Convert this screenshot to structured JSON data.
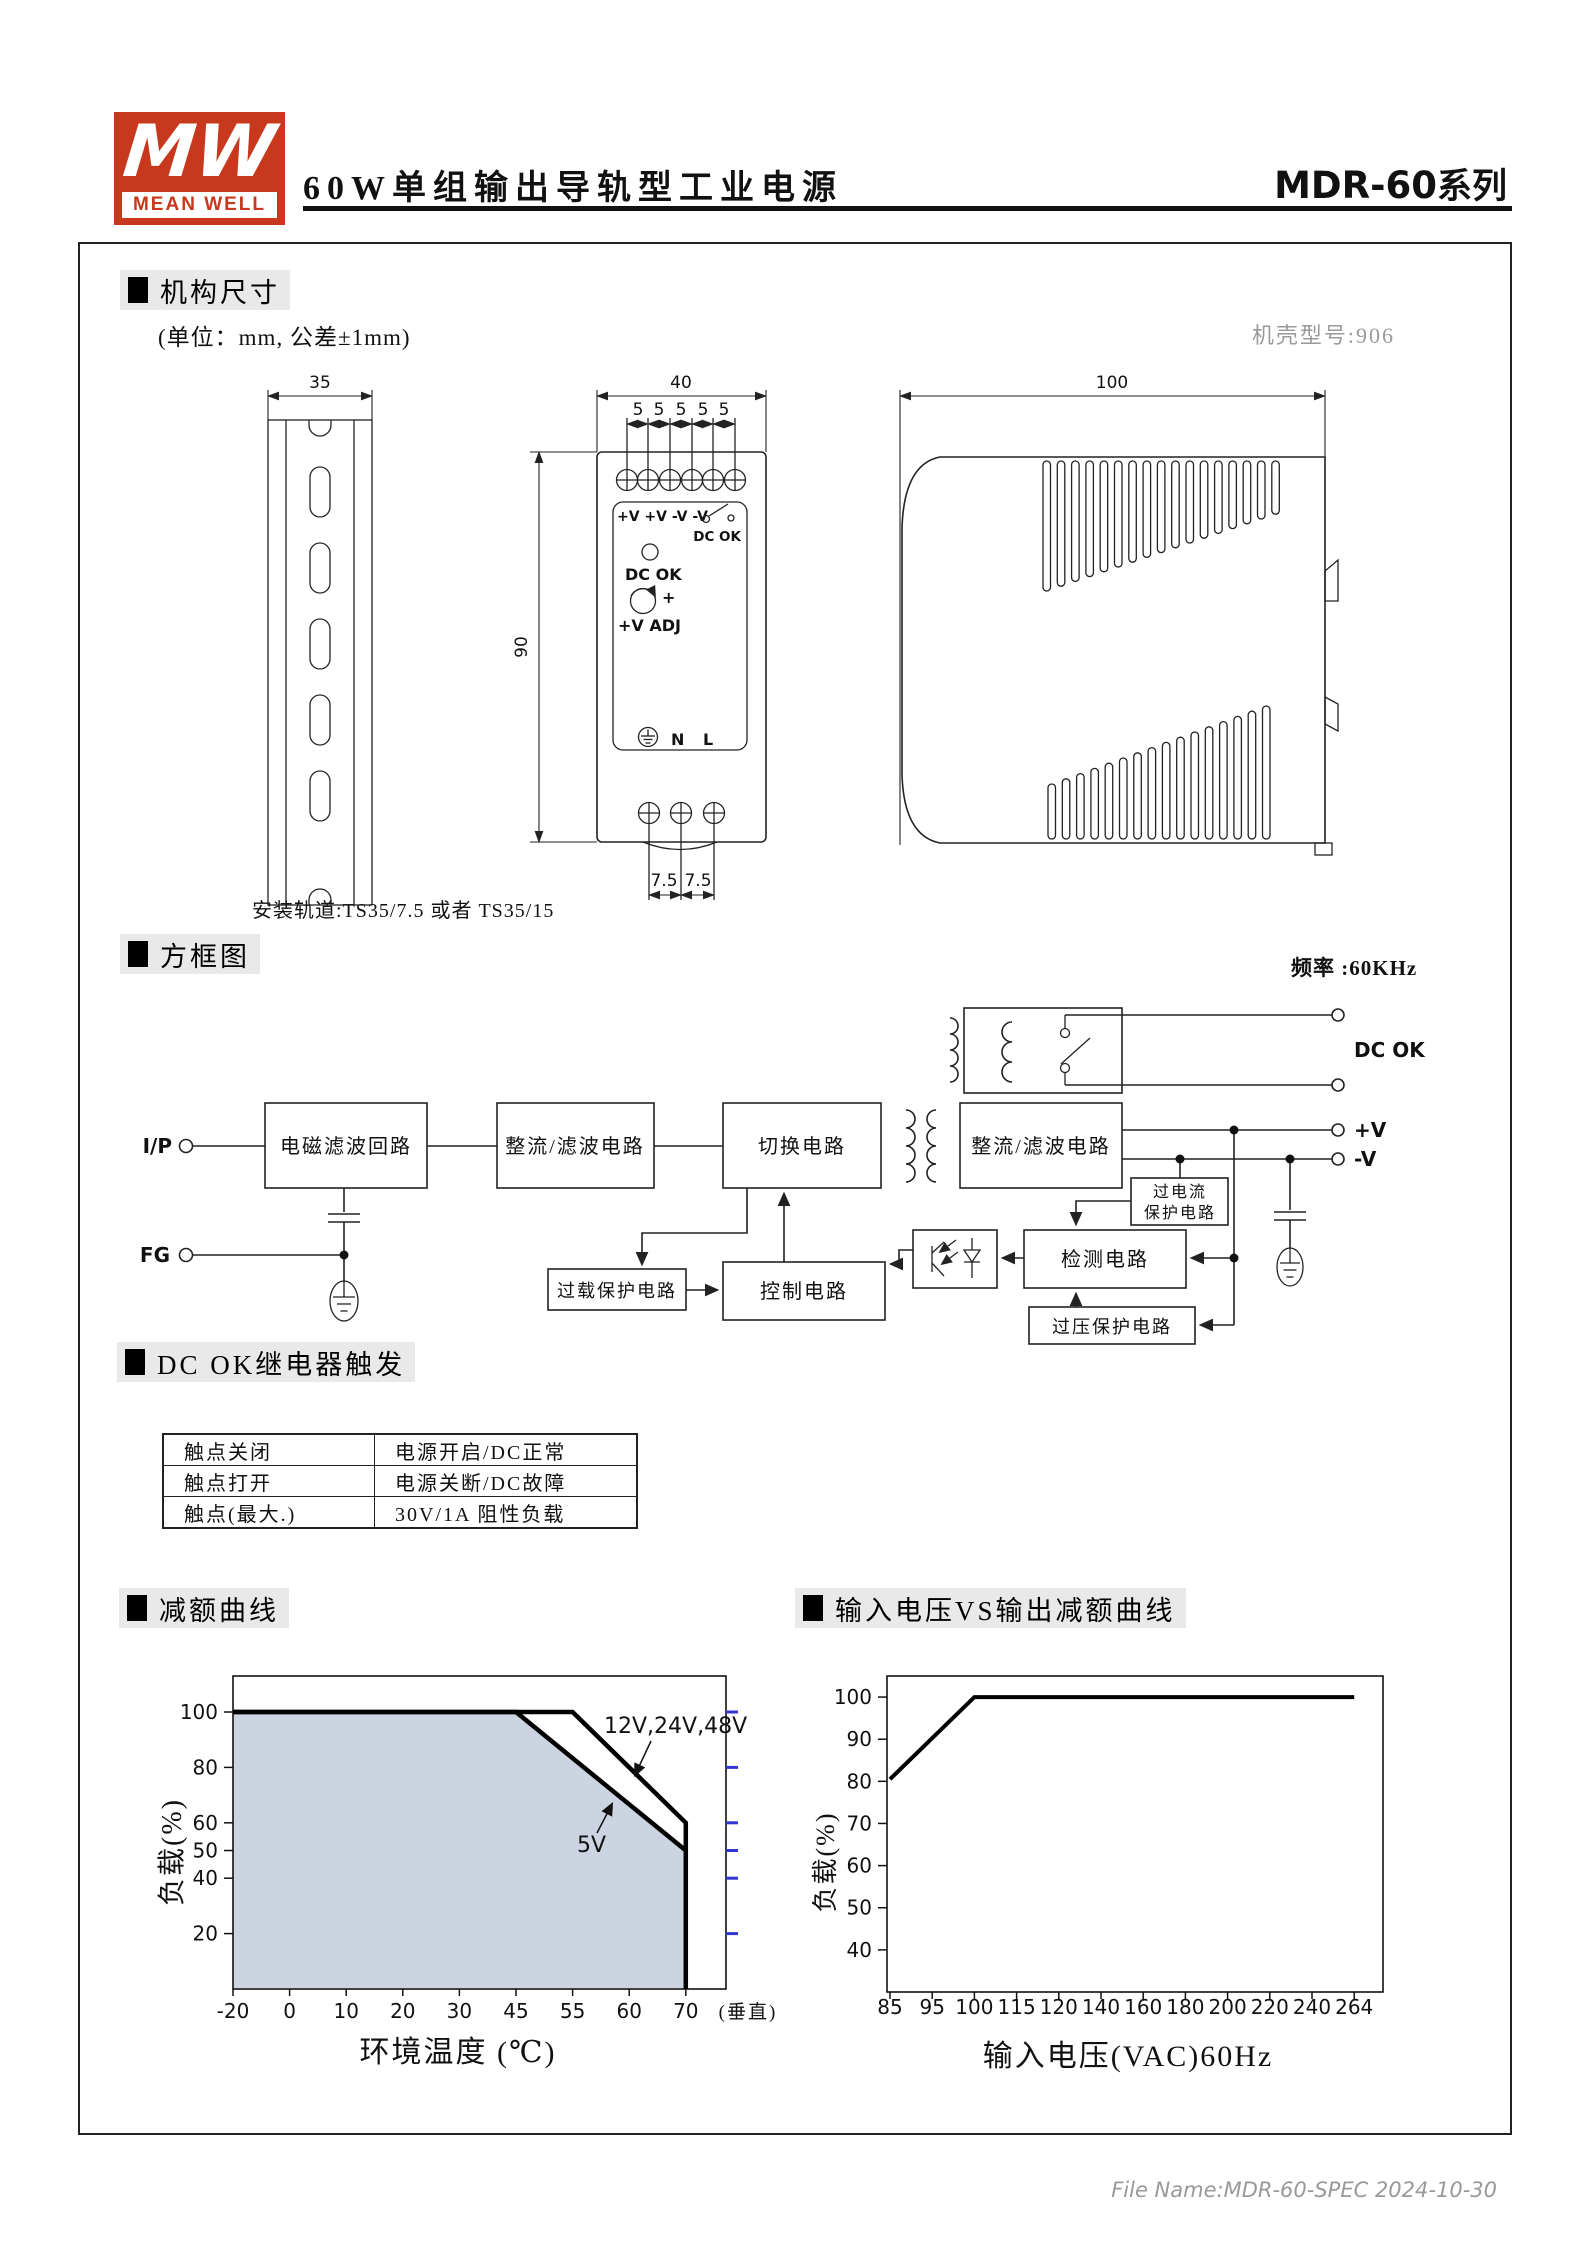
{
  "colors": {
    "brand_red": "#c8381c",
    "heading_bg": "#e9e9e9",
    "shade_fill": "#ccd4e2",
    "accent_blue": "#3434cf",
    "gray_text": "#9a9a9a"
  },
  "header": {
    "logo_mark": "MW",
    "logo_name": "MEAN WELL",
    "title": "60W单组输出导轨型工业电源",
    "series": "MDR-60",
    "series_suffix": "系列"
  },
  "mechanical": {
    "heading": "机构尺寸",
    "unit_note": "(单位：mm, 公差±1mm)",
    "case_note": "机壳型号:906",
    "rail_note": "安装轨道:TS35/7.5 或者 TS35/15",
    "dims": {
      "rail_width": "35",
      "body_width": "40",
      "body_height": "90",
      "depth": "100",
      "pitch": "5",
      "bottom_pitch": "7.5"
    },
    "front_panel": {
      "terminals": "+V +V -V -V",
      "relay_label": "DC OK",
      "led_label": "DC OK",
      "adj_plus": "+",
      "adj_label": "+V ADJ",
      "neutral": "N",
      "line": "L"
    }
  },
  "block_diagram": {
    "heading": "方框图",
    "frequency": "频率 :60KHz",
    "boxes": {
      "emi": "电磁滤波回路",
      "rectifier1": "整流/滤波电路",
      "switching": "切换电路",
      "rectifier2": "整流/滤波电路",
      "overload": "过载保护电路",
      "control": "控制电路",
      "detection": "检测电路",
      "overcurrent_l1": "过电流",
      "overcurrent_l2": "保护电路",
      "overvoltage": "过压保护电路"
    },
    "terminals": {
      "input": "I/P",
      "fg": "FG",
      "dcok": "DC OK",
      "vplus": "+V",
      "vminus": "-V"
    }
  },
  "relay_table": {
    "heading": "DC OK继电器触发",
    "rows": [
      [
        "触点关闭",
        "电源开启/DC正常"
      ],
      [
        "触点打开",
        "电源关断/DC故障"
      ],
      [
        "触点(最大.)",
        "30V/1A 阻性负载"
      ]
    ]
  },
  "chart_data": [
    {
      "type": "line",
      "title": "减额曲线",
      "xlabel": "环境温度 (℃)",
      "ylabel": "负载(%)",
      "x_ticks": [
        -20,
        0,
        10,
        20,
        30,
        45,
        55,
        60,
        70
      ],
      "x_suffix_label": "(垂直)",
      "y_ticks": [
        100,
        80,
        60,
        50,
        40,
        20
      ],
      "ylim": [
        0,
        113
      ],
      "grid": false,
      "series": [
        {
          "name": "12V,24V,48V",
          "points": [
            [
              -20,
              100
            ],
            [
              55,
              100
            ],
            [
              70,
              60
            ],
            [
              70,
              0
            ]
          ]
        },
        {
          "name": "5V",
          "points": [
            [
              -20,
              100
            ],
            [
              45,
              100
            ],
            [
              70,
              50
            ]
          ],
          "fill_below": true
        }
      ]
    },
    {
      "type": "line",
      "title": "输入电压VS输出减额曲线",
      "xlabel": "输入电压(VAC)60Hz",
      "ylabel": "负载(%)",
      "x_ticks": [
        85,
        95,
        100,
        115,
        120,
        140,
        160,
        180,
        200,
        220,
        240,
        264
      ],
      "y_ticks": [
        100,
        90,
        80,
        70,
        60,
        50,
        40
      ],
      "ylim": [
        30,
        105
      ],
      "grid": false,
      "series": [
        {
          "name": "",
          "points": [
            [
              85,
              80.5
            ],
            [
              100,
              100
            ],
            [
              264,
              100
            ]
          ]
        }
      ]
    }
  ],
  "footer": "File Name:MDR-60-SPEC  2024-10-30"
}
